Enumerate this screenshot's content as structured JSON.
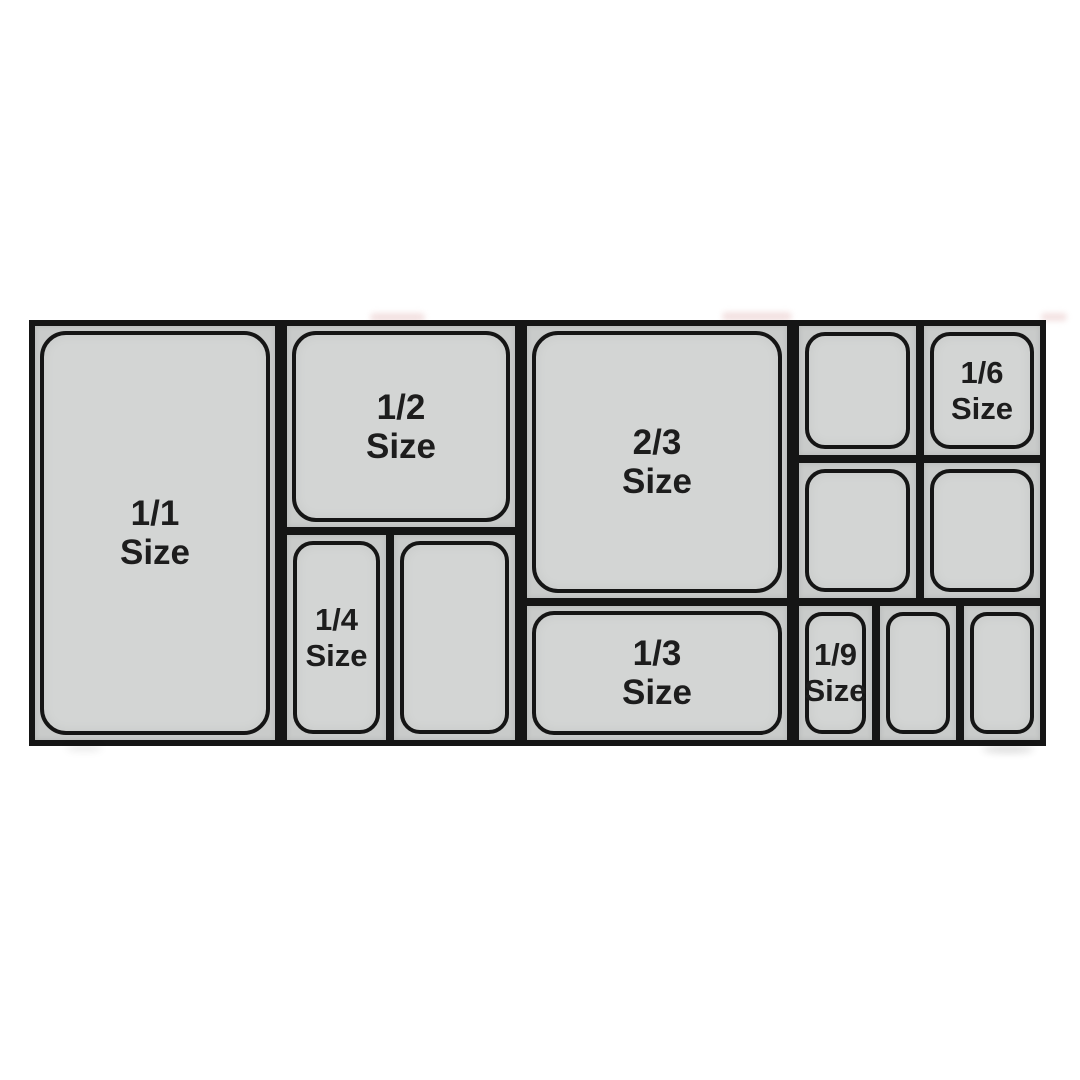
{
  "colors": {
    "background": "#ffffff",
    "frame": "#151515",
    "cell_fill": "#c9cbca",
    "pan_fill": "#d3d5d4",
    "label": "#1d1d1d",
    "artifact_pink": "#e9c9c9"
  },
  "labels": {
    "full": {
      "fraction": "1/1",
      "word": "Size"
    },
    "half": {
      "fraction": "1/2",
      "word": "Size"
    },
    "two_thirds": {
      "fraction": "2/3",
      "word": "Size"
    },
    "quarter": {
      "fraction": "1/4",
      "word": "Size"
    },
    "third": {
      "fraction": "1/3",
      "word": "Size"
    },
    "sixth": {
      "fraction": "1/6",
      "word": "Size"
    },
    "ninth": {
      "fraction": "1/9",
      "word": "Size"
    }
  }
}
